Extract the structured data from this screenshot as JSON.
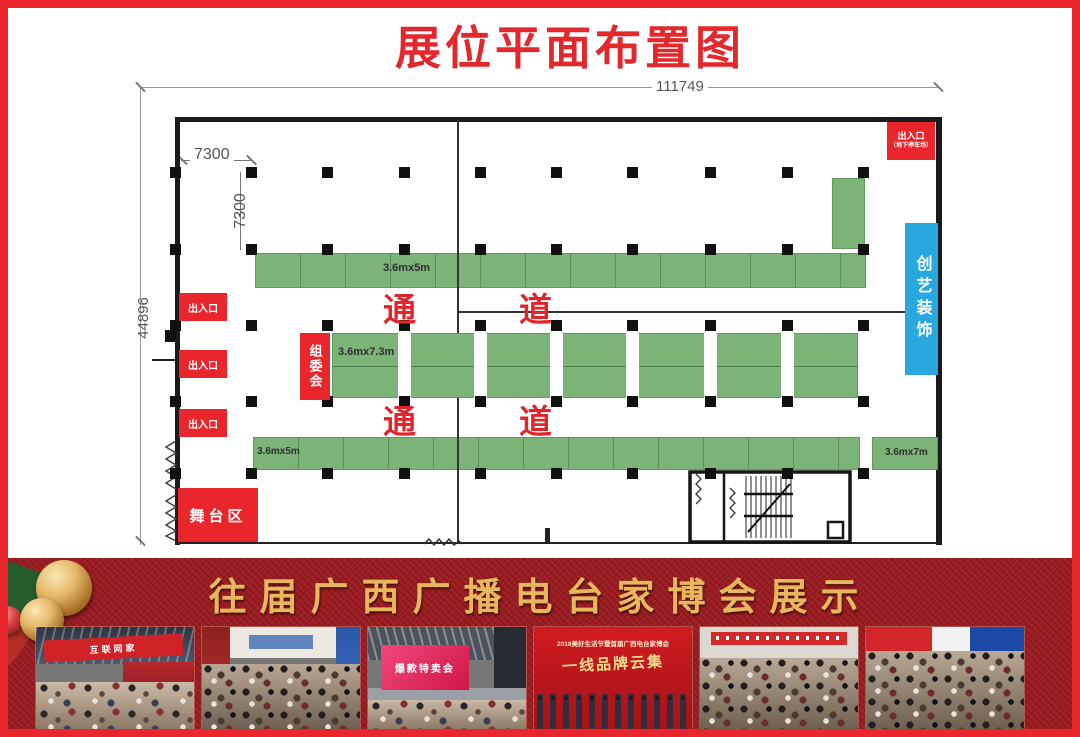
{
  "page_title": "展位平面布置图",
  "colors": {
    "accent_red": "#e8262b",
    "title_red": "#e3282d",
    "booth_green": "#7cb377",
    "info_blue": "#29a8e0",
    "banner_red": "#9e1d22",
    "gold": "#e6b75c"
  },
  "plan": {
    "dims": {
      "width_total": "111749",
      "height_total": "44896",
      "bay_width": "7300",
      "bay_height": "7300"
    },
    "aisle": {
      "char1": "通",
      "char2": "道"
    },
    "booths": {
      "top_row": "3.6mx5m",
      "middle_row": "3.6mx7.3m",
      "bottom_row_left": "3.6mx5m",
      "bottom_row_right": "3.6mx7m"
    },
    "rooms": {
      "parking_entrance": {
        "line1": "出入口",
        "line2": "（地下停车场）"
      },
      "exits": [
        "出入口",
        "出入口",
        "出入口"
      ],
      "committee": "组委会",
      "stage": "舞台区",
      "decorator": "创艺装饰"
    }
  },
  "banner": {
    "title": "往届广西广播电台家博会展示"
  },
  "photos": [
    {
      "alt": "exhibition-hall-with-red-banner",
      "banner_text": "互联网家"
    },
    {
      "alt": "crowded-exhibition-aisle"
    },
    {
      "alt": "stage-event",
      "screen_text": "爆款特卖会"
    },
    {
      "alt": "red-stage-lineup",
      "line1": "2018美好生活节暨首届广西电台家博会",
      "calligraphy": "一线品牌云集"
    },
    {
      "alt": "crowd-under-banner"
    },
    {
      "alt": "busy-booth-crowd"
    }
  ]
}
